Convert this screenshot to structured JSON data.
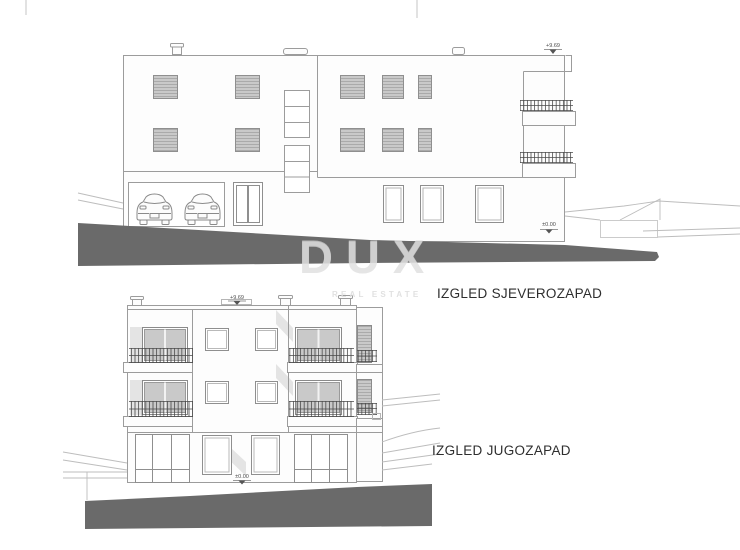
{
  "watermark": {
    "brand": "DUX",
    "subtitle": "REAL ESTATE"
  },
  "elevations": {
    "northwest": {
      "label": "IZGLED SJEVEROZAPAD",
      "level_top": "+9.69",
      "level_ground": "±0.00"
    },
    "southwest": {
      "label": "IZGLED JUGOZAPAD",
      "level_top": "+9.69",
      "level_ground": "±0.00"
    }
  },
  "colors": {
    "paper": "#ffffff",
    "outline": "#9c9c9c",
    "dark_detail": "#4a4a4a",
    "shutter_fill": "#c9c9c9",
    "glazing_fill": "#c9c9c9",
    "shadow_fill": "#e4e4e4",
    "ground_fill": "#6a6a6a",
    "watermark_gray": "#d6d6d6",
    "label_text": "#2e2e2e"
  }
}
